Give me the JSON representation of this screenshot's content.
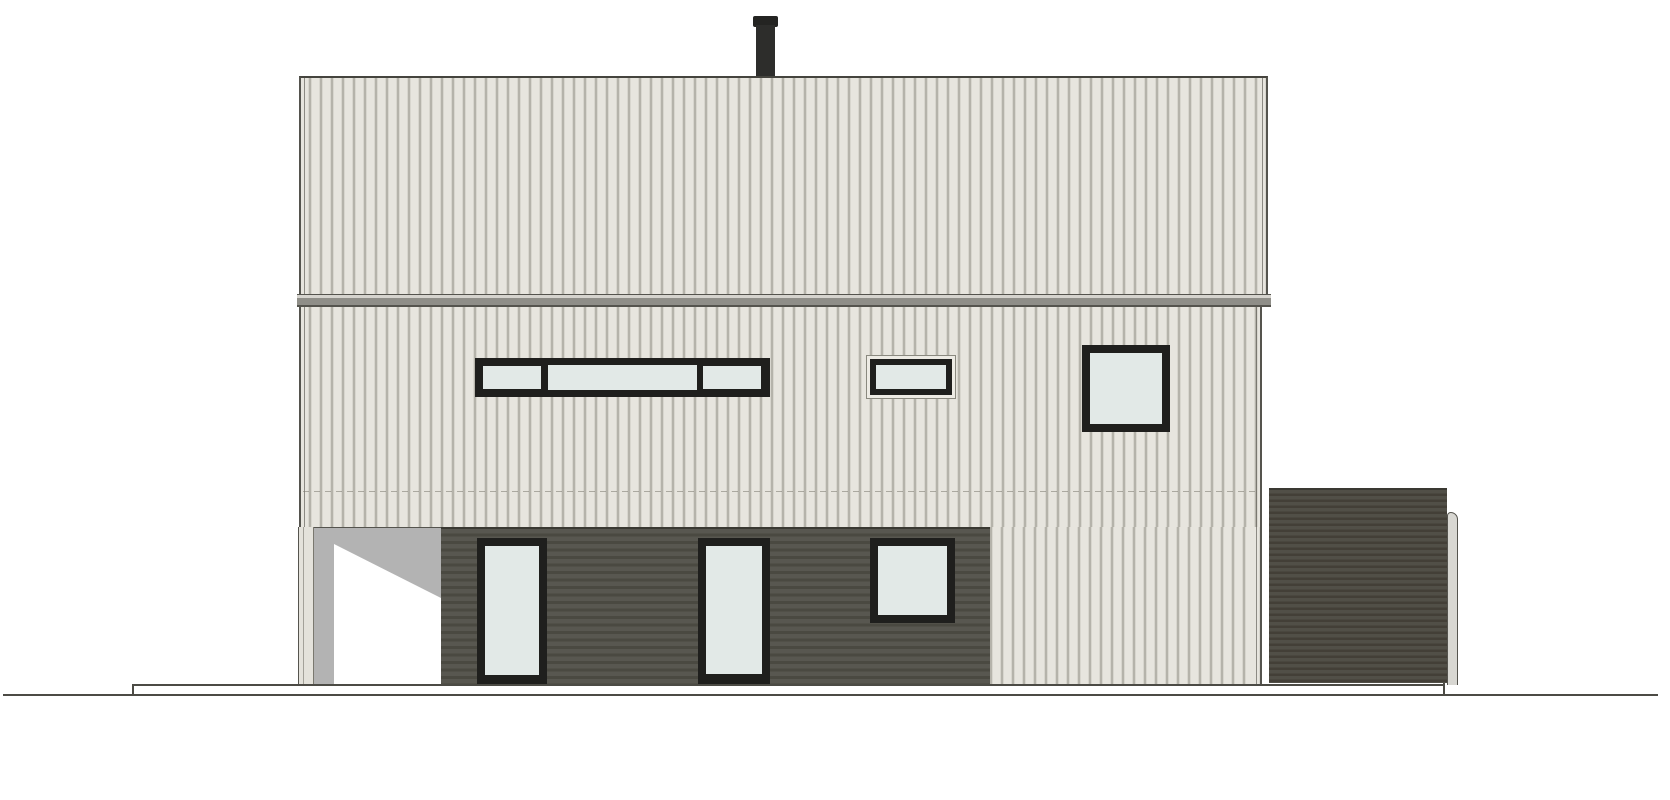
{
  "meta": {
    "type": "architectural-elevation-drawing",
    "subject": "single-family house, side elevation with annex",
    "background": "#ffffff",
    "text_content": "none"
  },
  "palette": {
    "wall_siding": "#e7e5de",
    "siding_batten": "#a19f96",
    "siding_batten_soft": "#c9c7be",
    "outline": "#55544e",
    "outline_dark": "#3a3932",
    "eave_band_light": "#d6d4ce",
    "eave_band_mid": "#8f8e88",
    "cladding_dark": "#585750",
    "cladding_dark_line": "#4a4941",
    "annex_dark": "#514f47",
    "annex_dark_line": "#433f37",
    "window_frame": "#1f1f1d",
    "glass": "#e2e9e7",
    "window_trim": "#edebe4",
    "recess_shadow": "#b3b3b3",
    "recess_light": "#ffffff",
    "chimney_body": "#2d2d2b",
    "chimney_cap": "#242422",
    "chimney_shadow": "#a09e96",
    "pipe_fill": "#d8d7d2",
    "ground_line": "#4c4b45"
  },
  "elements": {
    "chimney": "dark flue pipe with cap, top centre of roof",
    "upper_gable_wall": "upper storey / gable face, light vertical board-and-batten siding",
    "eave_band": "horizontal grey trim band between storeys",
    "main_wall": "main storey, light vertical board-and-batten siding",
    "entrance_recess": "open recessed corner at lower left with shadow",
    "dark_clad_wall": "ground-level section in dark horizontal cladding",
    "annex": "detached dark-clad annex / garage block at right with rounded downpipe",
    "foundation": "white slab band over continuous ground line"
  },
  "openings": {
    "ribbon_window": {
      "panes": 3,
      "location": "main wall, left of centre"
    },
    "vent_window": {
      "panes": 1,
      "location": "main wall, centre, light outer trim"
    },
    "square_window_upper": {
      "panes": 1,
      "location": "main wall, right"
    },
    "glass_door_left": {
      "panes": 1,
      "location": "dark clad wall"
    },
    "glass_door_right": {
      "panes": 1,
      "location": "dark clad wall"
    },
    "square_window_lower": {
      "panes": 1,
      "location": "dark clad wall, right"
    }
  }
}
